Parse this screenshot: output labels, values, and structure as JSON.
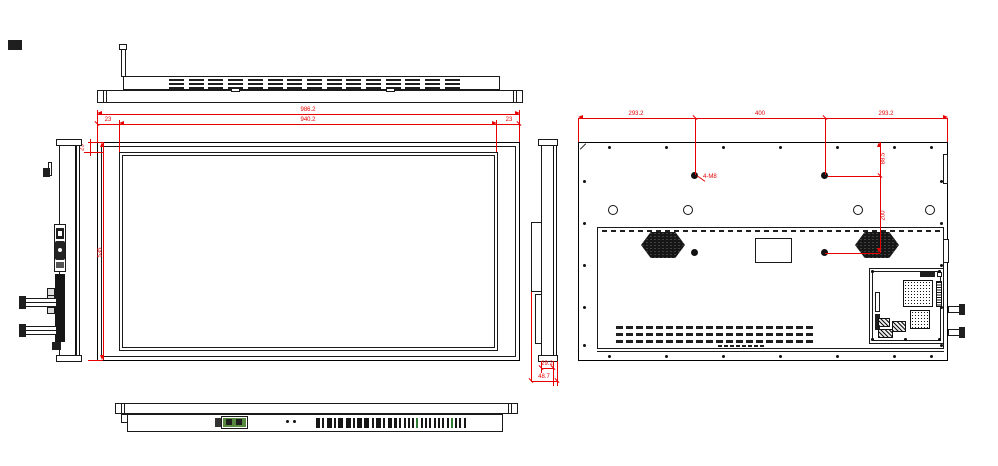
{
  "drawing": {
    "type": "engineering-drawing",
    "subject": "flat panel display orthographic views",
    "views": [
      "top",
      "front",
      "left-side",
      "right-side",
      "rear",
      "bottom"
    ],
    "colors": {
      "line": "#1a1a1a",
      "dimension": "#e60000",
      "connector_green": "#56883f"
    },
    "dimensions": {
      "front_overall_width": "986.2",
      "front_active_width": "940.2",
      "front_bezel_left": "23",
      "front_bezel_right": "23",
      "front_bezel_top": "23",
      "front_overall_height": "535",
      "rear_span_left": "293.2",
      "rear_vesa_horizontal": "400",
      "rear_span_right": "293.2",
      "rear_hole_label": "4-M8",
      "rear_hole_top_offset": "88.5",
      "rear_vesa_vertical": "200",
      "side_body_thickness": "29.2",
      "side_overall_depth": "48.7"
    }
  }
}
